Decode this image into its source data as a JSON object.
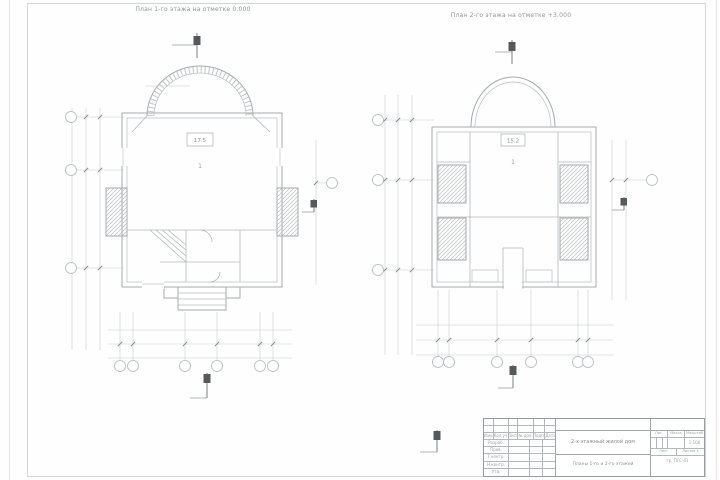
{
  "plans": [
    {
      "title": "План 1-го этажа на отметке 0.000",
      "room_tag": "17.5",
      "room_no": "1"
    },
    {
      "title": "План 2-го этажа на отметке +3.000",
      "room_tag": "15.2",
      "room_no": "1"
    }
  ],
  "title_block": {
    "header_cols": [
      "Изм.",
      "Кол.уч.",
      "Лист",
      "№ док.",
      "Подп.",
      "Дата"
    ],
    "sign_rows": [
      "Разраб.",
      "Пров.",
      "Т.контр.",
      "Н.контр.",
      "Утв."
    ],
    "doc_title": "2-х этажный жилой дом",
    "sheet_name": "Планы 1-го и 2-го этажей",
    "lit_label": "Лит.",
    "mass_label": "Масса",
    "scale_label": "Масштаб",
    "scale_value": "1:100",
    "list_label": "Лист",
    "listov_label": "Листов",
    "listov_value": "1",
    "org_name": "гр. ПГС-41"
  },
  "colors": {
    "wall_line": "#a6abae",
    "dim_line": "#c8cccd",
    "section_mark": "#55595d",
    "text": "#8d9396",
    "frame": "#d2d5d6"
  }
}
